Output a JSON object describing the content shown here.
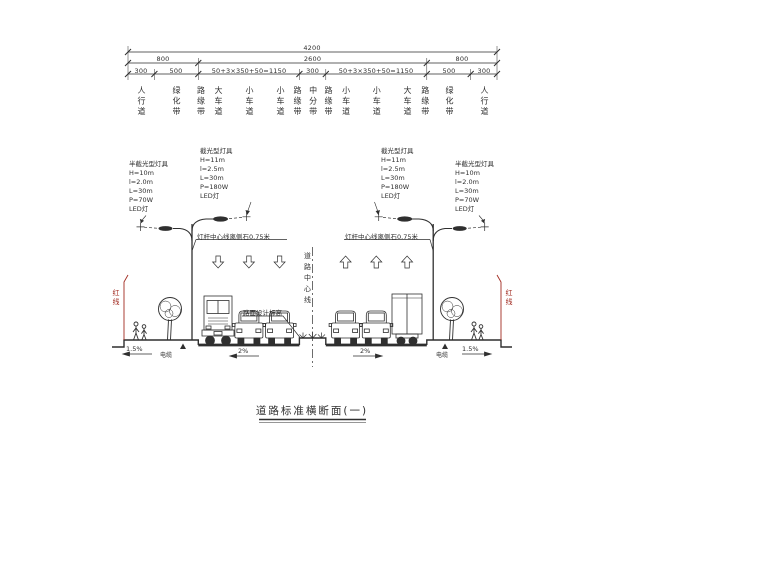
{
  "drawing": {
    "title": "道路标准横断面(一)"
  },
  "dims": {
    "total": "4200",
    "groups": [
      "800",
      "2600",
      "800"
    ],
    "segments": [
      "300",
      "500",
      "50+3×350+50=1150",
      "300",
      "50+3×350+50=1150",
      "500",
      "300"
    ]
  },
  "lanes": [
    "人行道",
    "绿化带",
    "路缘带",
    "大车道",
    "小车道",
    "小车道",
    "路缘带",
    "中分带",
    "路缘带",
    "小车道",
    "小车道",
    "大车道",
    "路缘带",
    "绿化带",
    "人行道"
  ],
  "luminaires": {
    "outer_left": {
      "title": "半截光型灯具",
      "lines": [
        "H=10m",
        "l=2.0m",
        "L=30m",
        "P=70W",
        "LED灯"
      ]
    },
    "inner_left": {
      "title": "截光型灯具",
      "lines": [
        "H=11m",
        "l=2.5m",
        "L=30m",
        "P=180W",
        "LED灯"
      ]
    },
    "inner_right": {
      "title": "截光型灯具",
      "lines": [
        "H=11m",
        "l=2.5m",
        "L=30m",
        "P=180W",
        "LED灯"
      ]
    },
    "outer_right": {
      "title": "半截光型灯具",
      "lines": [
        "H=10m",
        "l=2.0m",
        "L=30m",
        "P=70W",
        "LED灯"
      ]
    }
  },
  "annotations": {
    "pole_offset_left": "灯杆中心线离侧石0.75米",
    "pole_offset_right": "灯杆中心线离侧石0.75米",
    "road_centerline": "道路中心线",
    "pavement_design_elevation": "路面设计标高",
    "red_line_left": "红线",
    "red_line_right": "红线",
    "cable_left": "电缆",
    "cable_right": "电缆"
  },
  "slopes": {
    "sidewalk_left": "1.5%",
    "carriageway_left": "2%",
    "carriageway_right": "2%",
    "sidewalk_right": "1.5%"
  },
  "colors": {
    "ink": "#2f2f2f",
    "red_line": "#a22b21",
    "background": "#ffffff"
  }
}
